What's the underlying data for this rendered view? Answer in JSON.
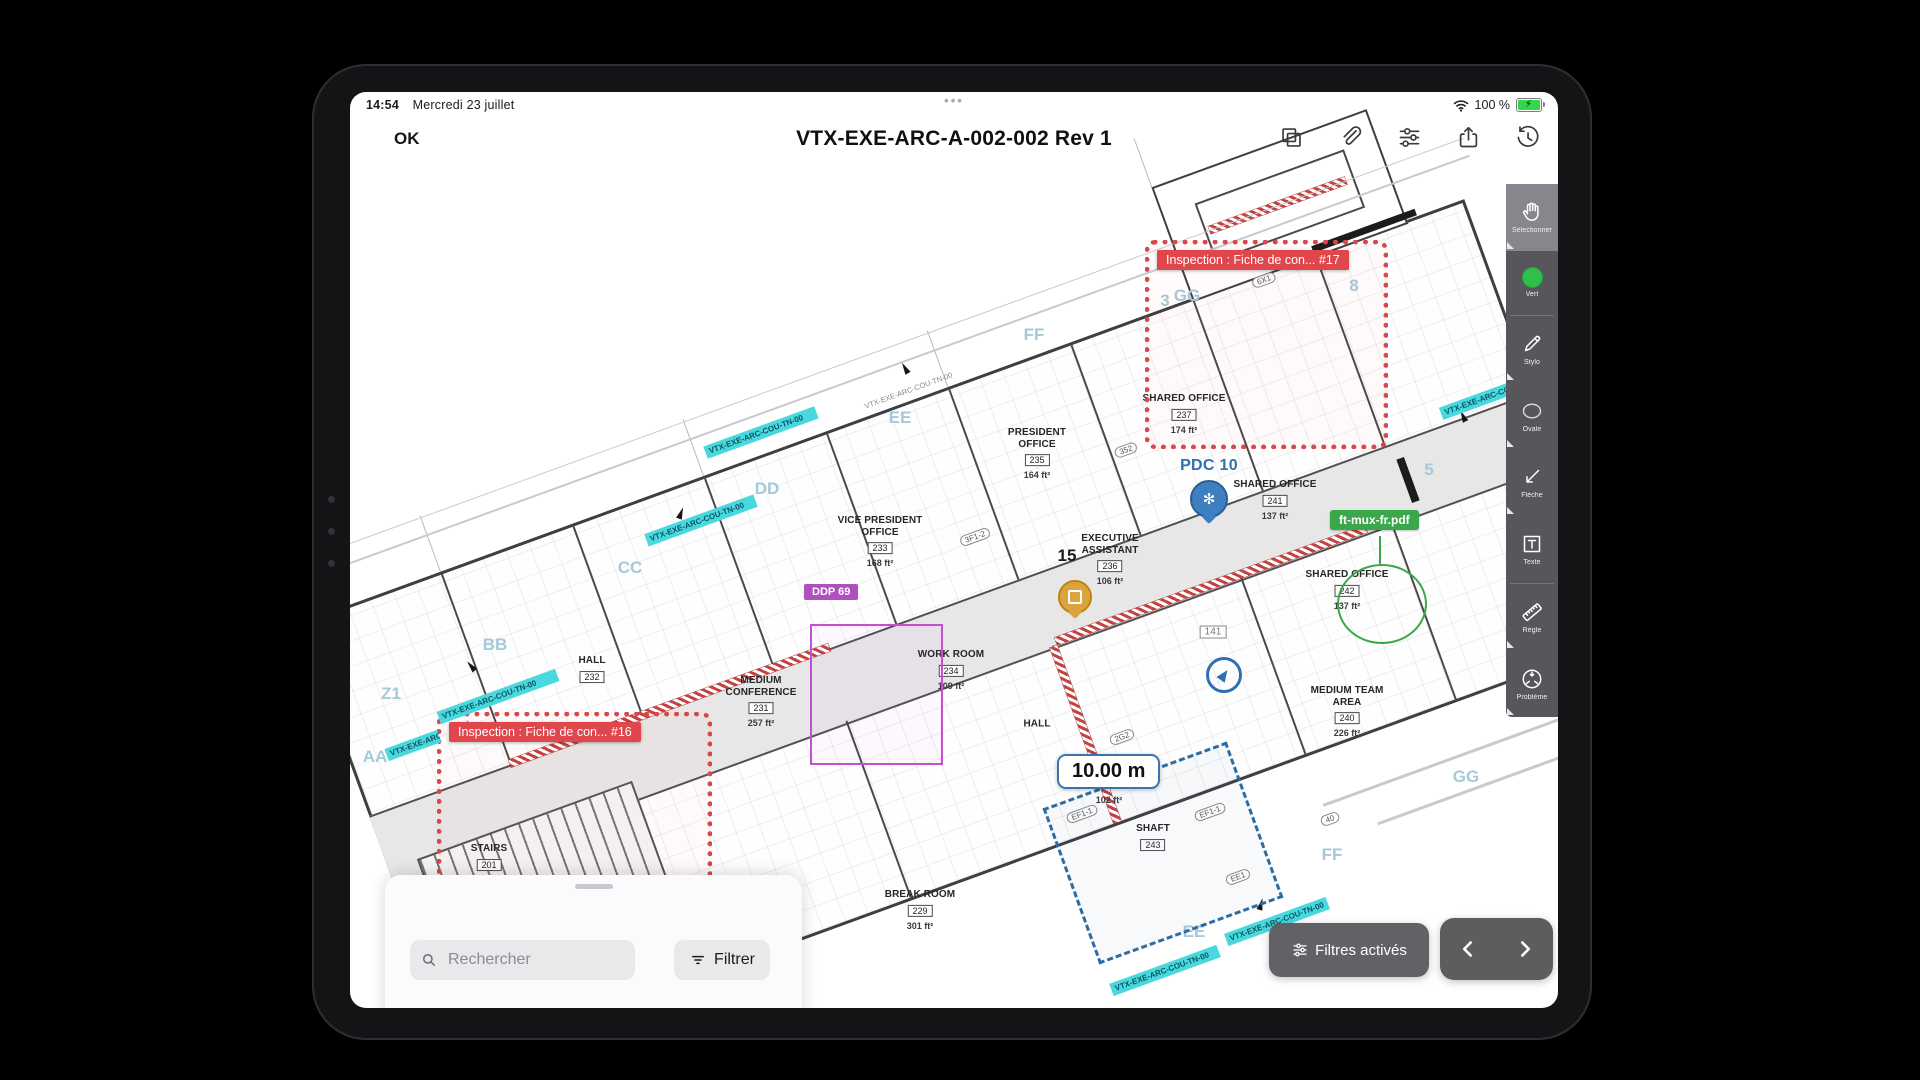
{
  "status": {
    "time": "14:54",
    "date": "Mercredi 23 juillet",
    "battery_percent": "100 %",
    "center_dots": "•••"
  },
  "navbar": {
    "back_label": "OK",
    "title": "VTX-EXE-ARC-A-002-002 Rev 1"
  },
  "toolbar": {
    "items": [
      {
        "label": "Sélectionner"
      },
      {
        "label": "Vert"
      },
      {
        "label": "Stylo"
      },
      {
        "label": "Ovale"
      },
      {
        "label": "Flèche"
      },
      {
        "label": "Texte"
      },
      {
        "label": "Règle"
      },
      {
        "label": "Problème"
      }
    ]
  },
  "plan": {
    "drawing_ref": "VTX-EXE-ARC-COU-TN-00",
    "rooms": [
      {
        "name": "PRESIDENT\nOFFICE",
        "number": "235",
        "area": "164 ft²"
      },
      {
        "name": "VICE PRESIDENT\nOFFICE",
        "number": "233",
        "area": "168 ft²"
      },
      {
        "name": "EXECUTIVE\nASSISTANT",
        "number": "236",
        "area": "106 ft²"
      },
      {
        "name": "SHARED OFFICE",
        "number": "237",
        "area": "174 ft²"
      },
      {
        "name": "SHARED OFFICE",
        "number": "241",
        "area": "137 ft²"
      },
      {
        "name": "SHARED OFFICE",
        "number": "242",
        "area": "137 ft²"
      },
      {
        "name": "MEDIUM TEAM\nAREA",
        "number": "240",
        "area": "226 ft²"
      },
      {
        "name": "MEDIUM\nCONFERENCE",
        "number": "231",
        "area": "257 ft²"
      },
      {
        "name": "HALL",
        "number": "232",
        "area": ""
      },
      {
        "name": "WORK ROOM",
        "number": "234",
        "area": "109 ft²"
      },
      {
        "name": "HALL",
        "number": "",
        "area": "102 ft²"
      },
      {
        "name": "SHAFT",
        "number": "243",
        "area": ""
      },
      {
        "name": "BREAK ROOM",
        "number": "229",
        "area": "301 ft²"
      },
      {
        "name": "STAIRS",
        "number": "201",
        "area": ""
      }
    ],
    "grid_letters": [
      "GG",
      "FF",
      "EE",
      "DD",
      "CC",
      "BB",
      "Z1",
      "AA",
      "GG",
      "FF",
      "EE",
      "3",
      "8",
      "5"
    ],
    "bubbles": [
      "6X1",
      "352",
      "3F1-2",
      "2G2",
      "EF1-1",
      "EF1-1",
      "40",
      "EE1"
    ],
    "annotations": {
      "inspection17": "Inspection : Fiche de con... #17",
      "inspection16": "Inspection : Fiche de con... #16",
      "ddp_label": "DDP 69",
      "file_label": "ft-mux-fr.pdf",
      "pdc_label": "PDC 10",
      "issue_number": "15",
      "ref_box": "141",
      "measurement": "10.00 m",
      "hall_area": "102 ft²"
    },
    "highlights": [
      "VTX-EXE-ARC-COU-TN-00",
      "VTX-EXE-ARC-COU-TN-00",
      "VTX-EXE-ARC-COU-TN-00",
      "VTX-EXE-ARC-COU-TN-00",
      "VTX-EXE-ARC-COU-TN-00",
      "VTX-EXE-ARC-COU-TN-00",
      "VTX-EXE-ARC-COU-TN-00"
    ]
  },
  "bottom_sheet": {
    "search_placeholder": "Rechercher",
    "filter_label": "Filtrer"
  },
  "footer": {
    "filters_active_label": "Filtres activés"
  },
  "colors": {
    "annotation_red": "#DD4A4E",
    "annotation_purple": "#B450C6",
    "annotation_green": "#3BA74B",
    "marker_blue": "#2E6FB3",
    "marker_yellow": "#DBA43F",
    "highlight_cyan": "#49D7E0",
    "measure_blue": "#2D6CA3",
    "battery_green": "#32D74B",
    "toolbar_gray": "#57565B"
  }
}
